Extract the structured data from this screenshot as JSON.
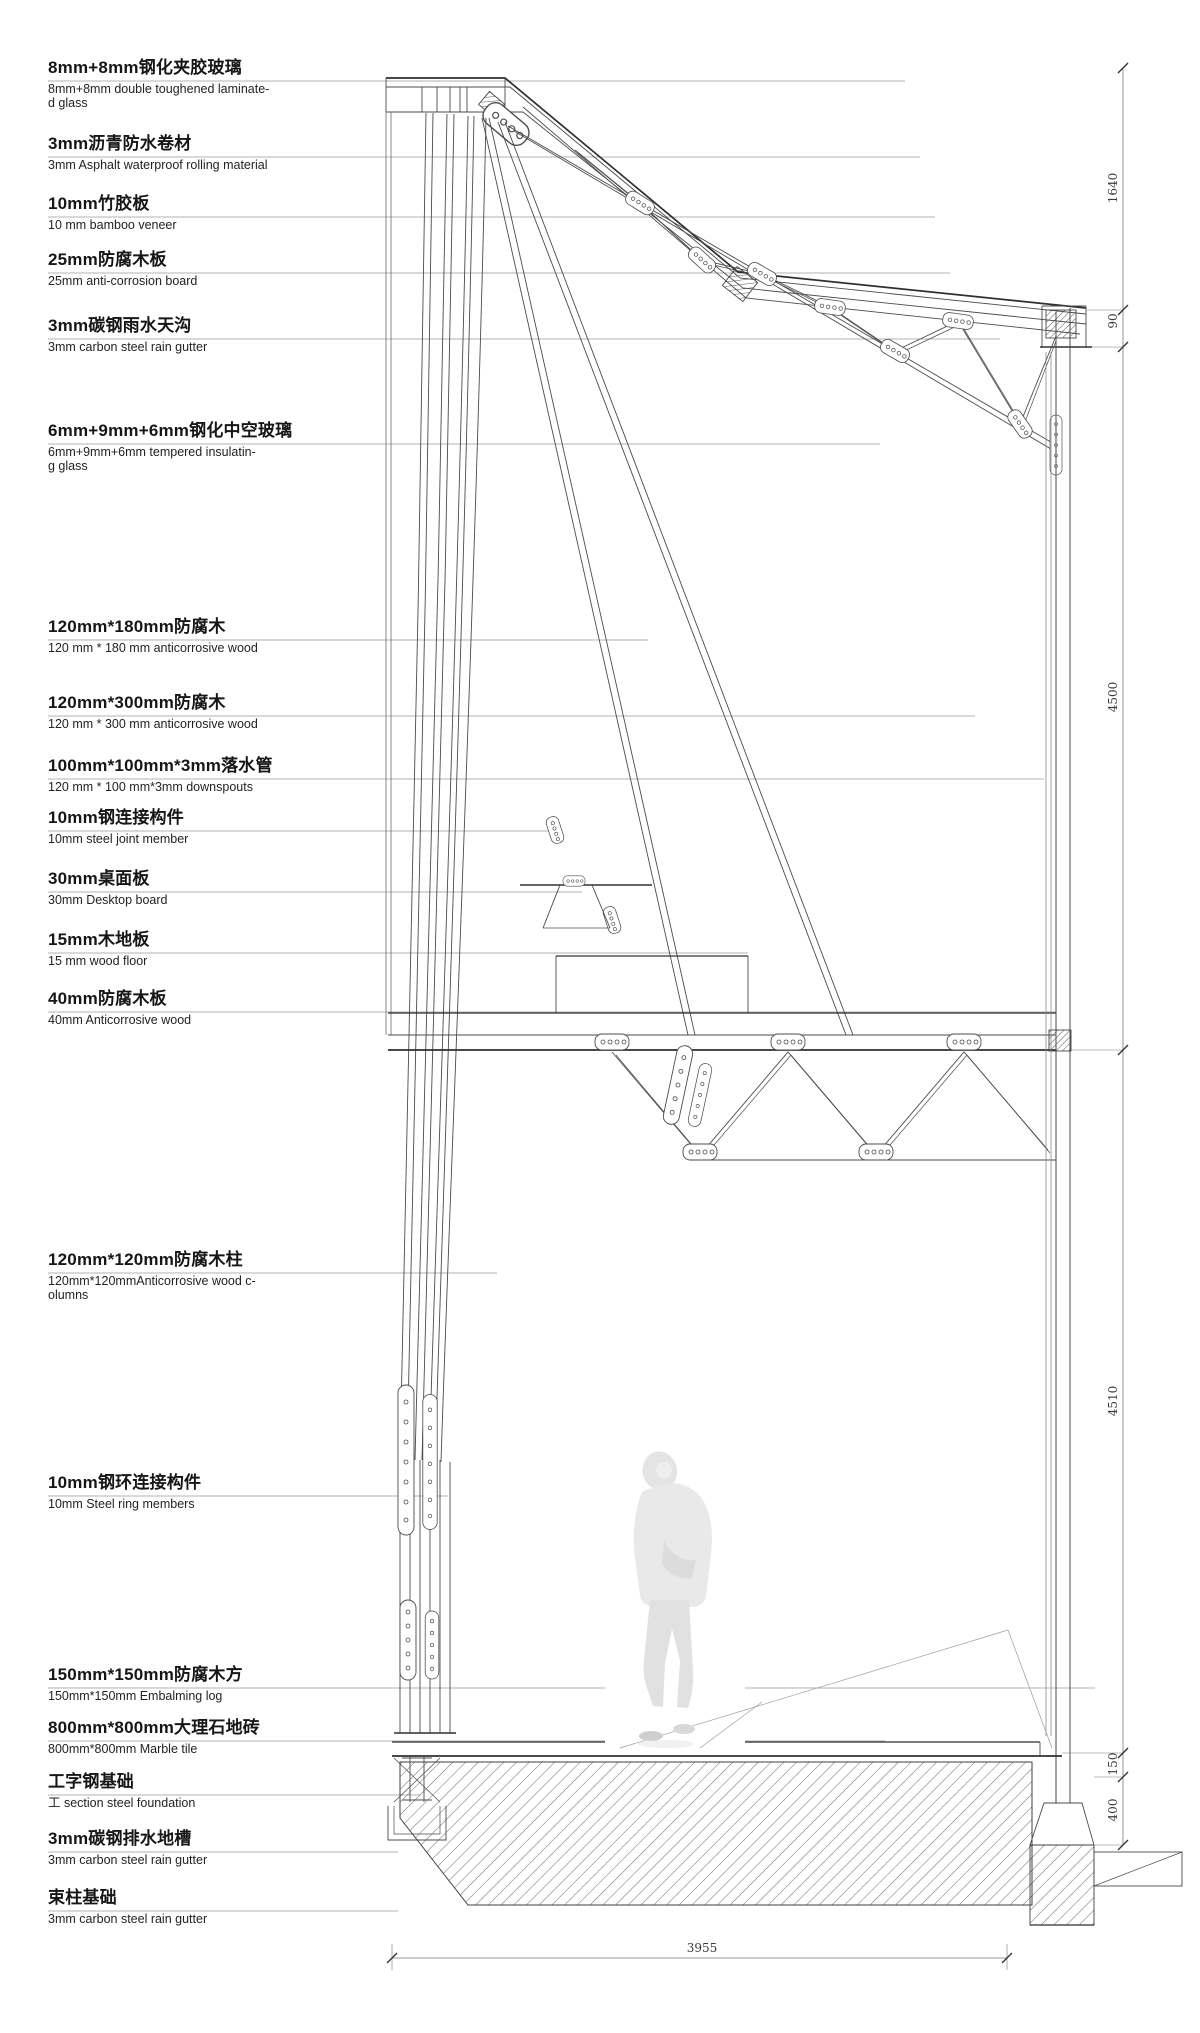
{
  "colors": {
    "line": "#4b4b4b",
    "text": "#161616",
    "leader": "#999999"
  },
  "annotations": [
    {
      "cn": "8mm+8mm钢化夹胶玻璃",
      "en": "8mm+8mm double toughened laminate-\nd glass"
    },
    {
      "cn": "3mm沥青防水卷材",
      "en": "3mm Asphalt waterproof rolling material"
    },
    {
      "cn": "10mm竹胶板",
      "en": "10 mm bamboo veneer"
    },
    {
      "cn": "25mm防腐木板",
      "en": "25mm anti-corrosion board"
    },
    {
      "cn": "3mm碳钢雨水天沟",
      "en": "3mm carbon steel rain gutter"
    },
    {
      "cn": "6mm+9mm+6mm钢化中空玻璃",
      "en": "6mm+9mm+6mm tempered insulatin-\ng glass"
    },
    {
      "cn": "120mm*180mm防腐木",
      "en": "120 mm * 180 mm anticorrosive wood"
    },
    {
      "cn": "120mm*300mm防腐木",
      "en": "120 mm * 300 mm anticorrosive wood"
    },
    {
      "cn": "100mm*100mm*3mm落水管",
      "en": "120 mm * 100 mm*3mm downspouts"
    },
    {
      "cn": "10mm钢连接构件",
      "en": "10mm steel joint member"
    },
    {
      "cn": "30mm桌面板",
      "en": "30mm Desktop board"
    },
    {
      "cn": "15mm木地板",
      "en": "15 mm wood floor"
    },
    {
      "cn": "40mm防腐木板",
      "en": "40mm Anticorrosive wood"
    },
    {
      "cn": "120mm*120mm防腐木柱",
      "en": "120mm*120mmAnticorrosive wood c-\nolumns"
    },
    {
      "cn": "10mm钢环连接构件",
      "en": "10mm Steel ring members"
    },
    {
      "cn": "150mm*150mm防腐木方",
      "en": "150mm*150mm Embalming log"
    },
    {
      "cn": "800mm*800mm大理石地砖",
      "en": "800mm*800mm Marble tile"
    },
    {
      "cn": "工字钢基础",
      "en": "工 section steel foundation"
    },
    {
      "cn": "3mm碳钢排水地槽",
      "en": "3mm carbon steel rain gutter"
    },
    {
      "cn": "束柱基础",
      "en": "3mm carbon steel rain gutter"
    }
  ],
  "dimensions": {
    "right": [
      "1640",
      "90",
      "4500",
      "4510",
      "150",
      "400"
    ],
    "bottom": [
      "3955"
    ]
  }
}
